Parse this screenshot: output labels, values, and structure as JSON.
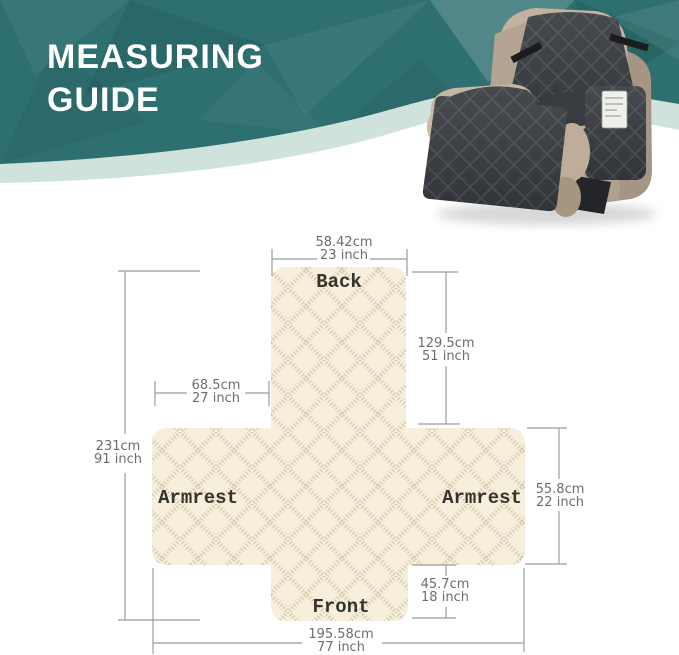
{
  "header": {
    "title_line1": "MEASURING",
    "title_line2": "GUIDE"
  },
  "hero": {
    "illustration": "recliner-chair-with-quilted-cover"
  },
  "diagram": {
    "panel_labels": {
      "back": "Back",
      "armrest_left": "Armrest",
      "armrest_right": "Armrest",
      "front": "Front"
    },
    "dimensions": {
      "back_width": {
        "cm": "58.42cm",
        "inch": "23 inch"
      },
      "back_height": {
        "cm": "129.5cm",
        "inch": "51 inch"
      },
      "seat_depth": {
        "cm": "68.5cm",
        "inch": "27 inch"
      },
      "total_length": {
        "cm": "231cm",
        "inch": "91 inch"
      },
      "armrest_height": {
        "cm": "55.8cm",
        "inch": "22 inch"
      },
      "front_drop": {
        "cm": "45.7cm",
        "inch": "18 inch"
      },
      "total_width": {
        "cm": "195.58cm",
        "inch": "77 inch"
      }
    }
  },
  "colors": {
    "teal": "#2e6f70",
    "teal-dark": "#245e61",
    "mint": "#cfe2dc",
    "fabric": "#f7efdc",
    "fabric-line": "#c9b691",
    "dim-line": "#9c9c9c",
    "dim-text": "#6d6d6d",
    "label-ink": "#35342c",
    "cover": "#3a3d41",
    "chair-tan": "#b5a593",
    "title-color": "#ffffff"
  }
}
